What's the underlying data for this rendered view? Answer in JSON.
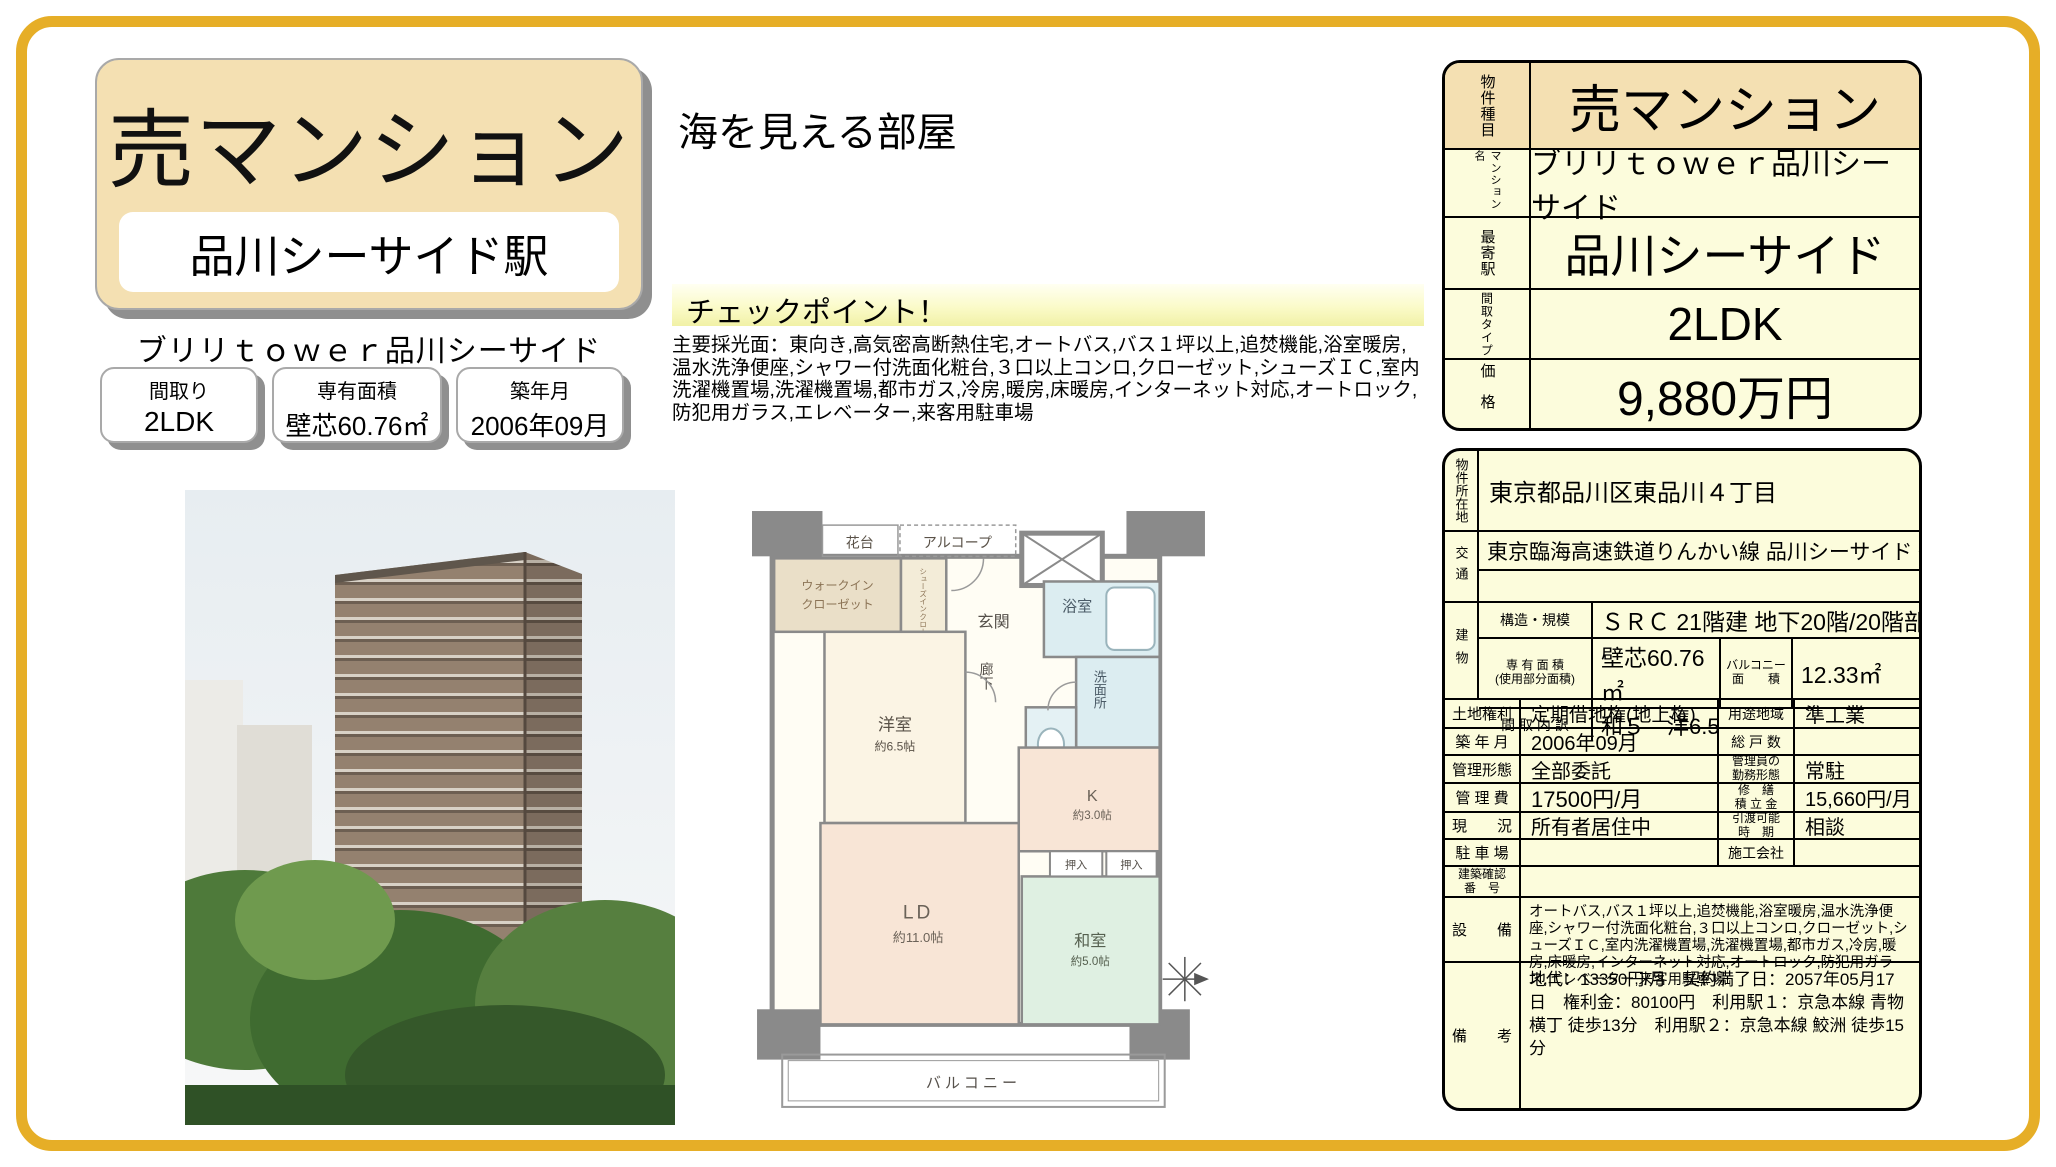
{
  "accent": {
    "frame_gold": "#E6AE27",
    "beige": "#F4E0B2",
    "pale_yellow": "#FCFCDC"
  },
  "header_left": {
    "property_type": "売マンション",
    "station": "品川シーサイド駅",
    "building_name": "ブリリｔｏｗｅｒ品川シーサイド",
    "stats": [
      {
        "label": "間取り",
        "value": "2LDK"
      },
      {
        "label": "専有面積",
        "value": "壁芯60.76㎡"
      },
      {
        "label": "築年月",
        "value": "2006年09月"
      }
    ]
  },
  "catch": {
    "headline": "海を見える部屋",
    "checkpoint_title": "チェックポイント！",
    "checkpoint_body": "主要採光面：東向き,高気密高断熱住宅,オートバス,バス１坪以上,追焚機能,浴室暖房,温水洗浄便座,シャワー付洗面化粧台,３口以上コンロ,クローゼット,シューズＩＣ,室内洗濯機置場,洗濯機置場,都市ガス,冷房,暖房,床暖房,インターネット対応,オートロック,防犯用ガラス,エレベーター,来客用駐車場"
  },
  "summary_table": {
    "rows": [
      {
        "label": "物件種目",
        "value": "売マンション"
      },
      {
        "label": "マンション名",
        "value": "ブリリｔｏｗｅｒ品川シーサイド"
      },
      {
        "label": "最寄駅",
        "value": "品川シーサイド"
      },
      {
        "label": "間取タイプ",
        "value": "2LDK"
      },
      {
        "label": "価格",
        "value": "9,880万円"
      }
    ]
  },
  "detail_table": {
    "address": {
      "label": "物件所在地",
      "value": "東京都品川区東品川４丁目"
    },
    "access": {
      "label": "交通",
      "value": "東京臨海高速鉄道りんかい線 品川シーサイド 徒歩1分"
    },
    "building": {
      "label": "建物",
      "structure": {
        "label": "構造・規模",
        "value": "ＳＲＣ 21階建 地下20階/20階部分"
      },
      "area": {
        "label": "専 有 面 積\n(使用部分面積)",
        "value": "壁芯60.76㎡",
        "balcony_label": "バルコニー\n面　　積",
        "balcony_value": "12.33㎡"
      },
      "layout": {
        "label": "間 取 内 訳",
        "value": "和５　洋6.5"
      }
    },
    "pairs": [
      {
        "label1": "土地権利",
        "value1": "定期借地権(地上権)",
        "label2": "用途地域",
        "value2": "準工業"
      },
      {
        "label1": "築 年 月",
        "value1": "2006年09月",
        "label2": "総 戸 数",
        "value2": ""
      },
      {
        "label1": "管理形態",
        "value1": "全部委託",
        "label2": "管理員の\n勤務形態",
        "value2": "常駐"
      },
      {
        "label1": "管 理 費",
        "value1": "17500円/月",
        "label2": "修　繕\n積 立 金",
        "value2": "15,660円/月"
      },
      {
        "label1": "現　　況",
        "value1": "所有者居住中",
        "label2": "引渡可能\n時　期",
        "value2": "相談"
      },
      {
        "label1": "駐 車 場",
        "value1": "",
        "label2": "施工会社",
        "value2": ""
      }
    ],
    "building_confirmation": {
      "label": "建築確認\n番　号",
      "value": ""
    },
    "facilities": {
      "label": "設　　備",
      "value": "オートバス,バス１坪以上,追焚機能,浴室暖房,温水洗浄便座,シャワー付洗面化粧台,３口以上コンロ,クローゼット,シューズＩＣ,室内洗濯機置場,洗濯機置場,都市ガス,冷房,暖房,床暖房,インターネット対応,オートロック,防犯用ガラス,エレベーター,来客用駐車場"
    },
    "remarks": {
      "label": "備　　考",
      "value": "地代：13350円/月　契約満了日：2057年05月17日　権利金：80100円　利用駅１：京急本線 青物横丁 徒歩13分　利用駅２：京急本線 鮫洲 徒歩15分"
    }
  },
  "floor_plan": {
    "labels": {
      "hanadai": "花台",
      "alcove": "アルコープ",
      "wic_line1": "ウォークイン",
      "wic_line2": "クローゼット",
      "sic": "シューズインクローゼット",
      "genkan": "玄関",
      "bath": "浴室",
      "hall": "廊下",
      "wash": "洗面所",
      "western_room": "洋室",
      "western_size": "約6.5帖",
      "kitchen": "K",
      "kitchen_size": "約3.0帖",
      "living": "LD",
      "living_size": "約11.0帖",
      "japanese_room": "和室",
      "japanese_size": "約5.0帖",
      "closet1": "押入",
      "closet2": "押入",
      "balcony": "バルコニー"
    }
  }
}
